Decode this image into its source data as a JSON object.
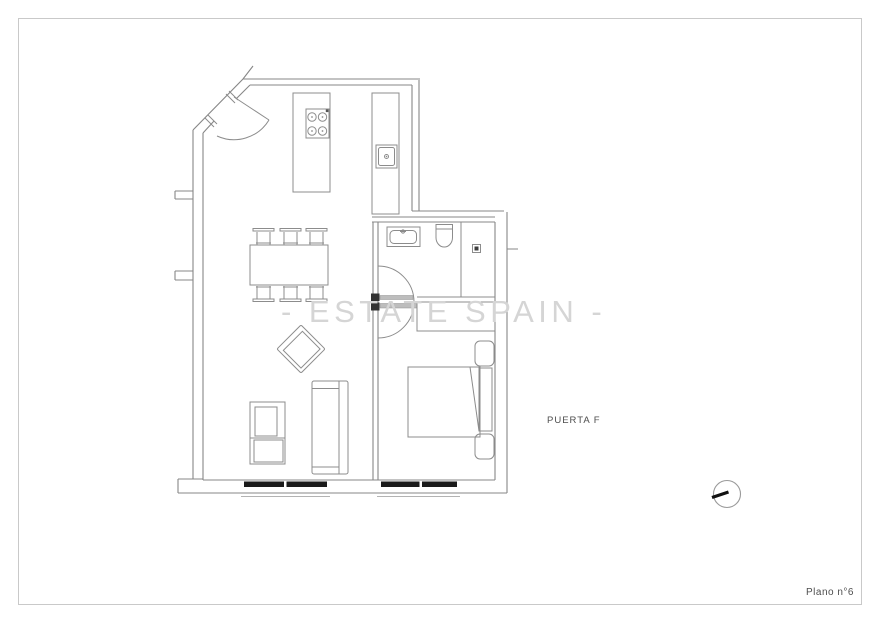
{
  "page": {
    "background": "#ffffff",
    "border_color": "#c9c9c9"
  },
  "plan": {
    "watermark_text": "- ESTATE SPAIN -",
    "watermark_color": "#d5d5d5",
    "door_label": "PUERTA F",
    "sheet_label": "Plano n°6",
    "label_color": "#4d4d4d",
    "line_color": "#8c8c8c",
    "wall_color": "#878787",
    "window_fill": "#1a1a1a",
    "north_hand_color": "#111111",
    "symbols": [
      "entrance-door",
      "kitchen-island",
      "stove",
      "kitchen-counter",
      "kitchen-sink",
      "dining-table",
      "dining-chair",
      "armchair",
      "tv-unit",
      "sofa",
      "bathroom-sink",
      "toilet",
      "shower-drain",
      "interior-door-arc",
      "wardrobe",
      "double-bed",
      "window",
      "north-indicator"
    ]
  }
}
